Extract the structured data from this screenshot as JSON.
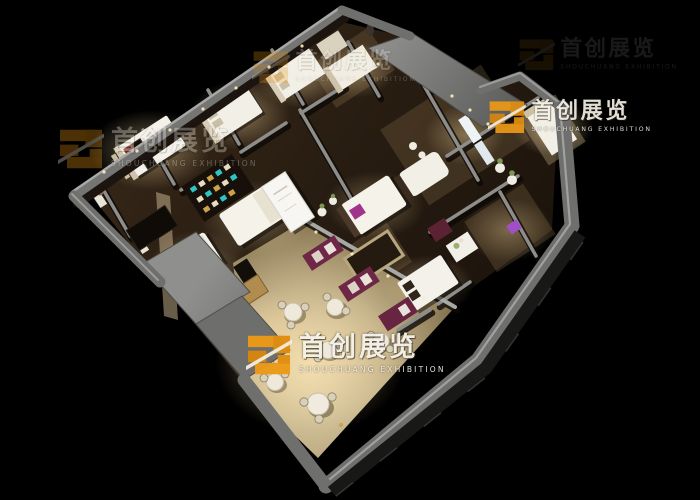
{
  "scene": {
    "type": "3d-isometric-interior-render",
    "subject": "Bird's-eye cutaway render of a spa / beauty-salon exhibition interior with bedrooms, massage rooms, retail display walls and a cafe seating corner on a black background",
    "background_color": "#000000",
    "palette": {
      "outer_wall_gray": "#6f6f6d",
      "wall_highlight": "#a0a09e",
      "wood_floor_dark": "#241a10",
      "cafe_floor_beige": "#d9c8a0",
      "warm_light": "#ffe2a8",
      "bed_white": "#f4f1ea",
      "poster_wine": "#6e2746",
      "accent_purple": "#a14fc9",
      "accent_teal": "#2ec4c4"
    }
  },
  "watermark": {
    "cn": "首创展览",
    "en": "SHOUCHUANG EXHIBITION",
    "logo": {
      "name": "shouchuang-logo",
      "primary": "#ec9a16",
      "secondary": "#d8860e",
      "slash": "#f5ecd8"
    },
    "instances": [
      {
        "id": "top-center",
        "opacity": 0.26
      },
      {
        "id": "top-right",
        "opacity": 0.92
      },
      {
        "id": "mid-left",
        "opacity": 0.32
      },
      {
        "id": "bottom-center",
        "opacity": 0.96
      },
      {
        "id": "far-top-right",
        "opacity": 0.1
      }
    ]
  }
}
